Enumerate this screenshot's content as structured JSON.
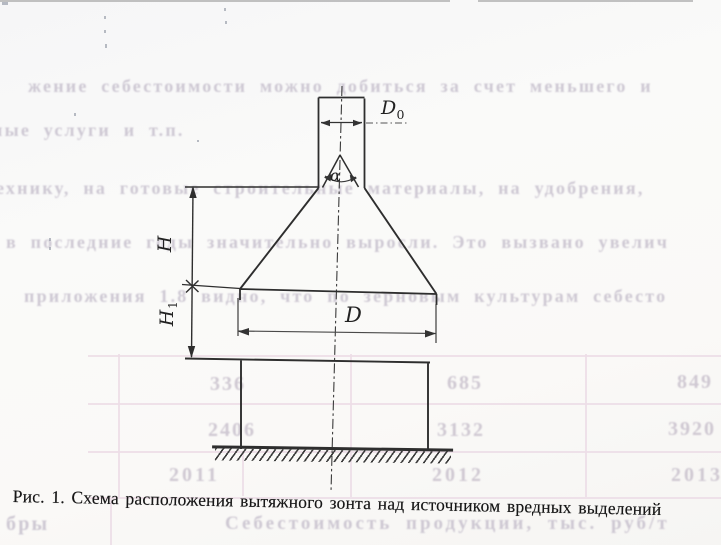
{
  "page": {
    "caption": "Рис. 1. Схема расположения вытяжного зонта над источником вредных выделений",
    "diagram": {
      "labels": {
        "duct_diameter": {
          "main": "D",
          "sub": "0"
        },
        "height_upper": "H",
        "height_lower": {
          "main": "H",
          "sub": "1"
        },
        "hood_diameter": "D",
        "flare_angle": "α"
      }
    },
    "bleed_through": {
      "text_lines": [
        {
          "text": "жение себестоимости можно добиться за счет меньшего и"
        },
        {
          "text": "ные услуги и т.п."
        },
        {
          "text": "технику, на готовые строительные материалы, на удобрения,"
        },
        {
          "text": "в последние годы значительно выросли. Это вызвано увелич"
        },
        {
          "text": "приложения 1.8 видно, что по зерновым культурам себесто"
        },
        {
          "text": "Себестоимость продукции, тыс. руб/т"
        },
        {
          "text": "бры"
        }
      ],
      "table_numbers": [
        {
          "v": "336"
        },
        {
          "v": "685"
        },
        {
          "v": "849"
        },
        {
          "v": "2406"
        },
        {
          "v": "3132"
        },
        {
          "v": "3920"
        },
        {
          "v": "2011"
        },
        {
          "v": "2012"
        },
        {
          "v": "2013"
        }
      ]
    },
    "colors": {
      "ink": "#2e2e2e",
      "bleed_text": "#c3bcca",
      "bleed_grid": "#ecdde6",
      "paper": "#faf9f7"
    }
  }
}
